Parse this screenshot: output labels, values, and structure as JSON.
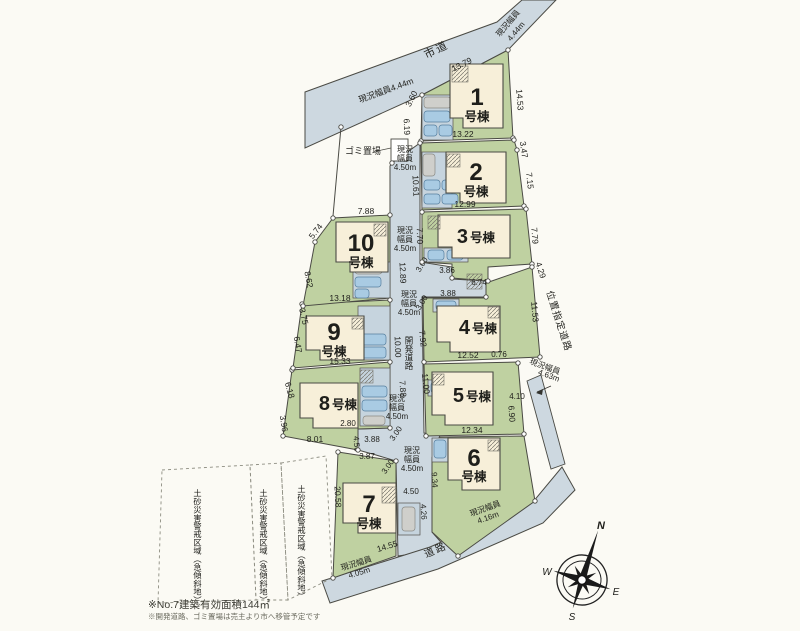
{
  "labels": {
    "city_road": "市道",
    "dev_road": "開発道路",
    "designated_road": "位置指定道路",
    "road": "道路",
    "garbage": "ゴミ置場",
    "genkyo": "現況",
    "fukuin": "幅員",
    "genkyo_fukuin": "現況幅員",
    "w444": "現況幅員4.44m",
    "w444b": "4.44m",
    "w450": "4.50m",
    "w463": "4.63m",
    "w405": "4.05m",
    "w416": "4.16m",
    "hazard": "土砂災害警戒区域（急傾斜地）",
    "suffix": "号棟",
    "note1": "※No.7建築有効面積144㎡",
    "note2": "※開発道路、ゴミ置場は売主より市へ移管予定です"
  },
  "compass": {
    "n": "N",
    "e": "E",
    "s": "S",
    "w": "W"
  },
  "lots": [
    "1",
    "2",
    "3",
    "4",
    "5",
    "6",
    "7",
    "8",
    "9",
    "10"
  ],
  "dims": {
    "l1": {
      "a": "13.79",
      "b": "14.53",
      "c": "13.22",
      "d": "3.60",
      "e": "6.19"
    },
    "l2": {
      "a": "3.47",
      "b": "7.15",
      "c": "12.99",
      "d": "10.61"
    },
    "l3": {
      "a": "7.70",
      "b": "7.79",
      "c": "4.29",
      "d": "3.86",
      "e": "6.74",
      "f": "3.88",
      "g": "3.00",
      "h": "3.00"
    },
    "l4": {
      "a": "11.53",
      "b": "12.52",
      "c": "0.76"
    },
    "l5": {
      "a": "4.10",
      "b": "6.90",
      "c": "12.34"
    },
    "l7": {
      "a": "20.58",
      "b": "14.55",
      "c": "3.87",
      "d": "3.00",
      "e": "4.50",
      "f": "4.26",
      "g": "9.34"
    },
    "l8": {
      "a": "6.18",
      "b": "3.96",
      "c": "8.01",
      "d": "2.80",
      "e": "3.88",
      "f": "4.50",
      "g": "3.00",
      "h": "7.88"
    },
    "l9": {
      "a": "13.18",
      "b": "3.75",
      "c": "6.47",
      "d": "15.33"
    },
    "l10": {
      "a": "7.88",
      "b": "5.74",
      "c": "8.62"
    },
    "rd": {
      "a": "12.89",
      "b": "10.00",
      "c": "7.92",
      "d": "11.00"
    }
  },
  "colors": {
    "road": "#cdd8e0",
    "yard": "#bfd1a1",
    "house": "#f7efd9",
    "car": "#a9cbe3",
    "line": "#4a4a44"
  }
}
